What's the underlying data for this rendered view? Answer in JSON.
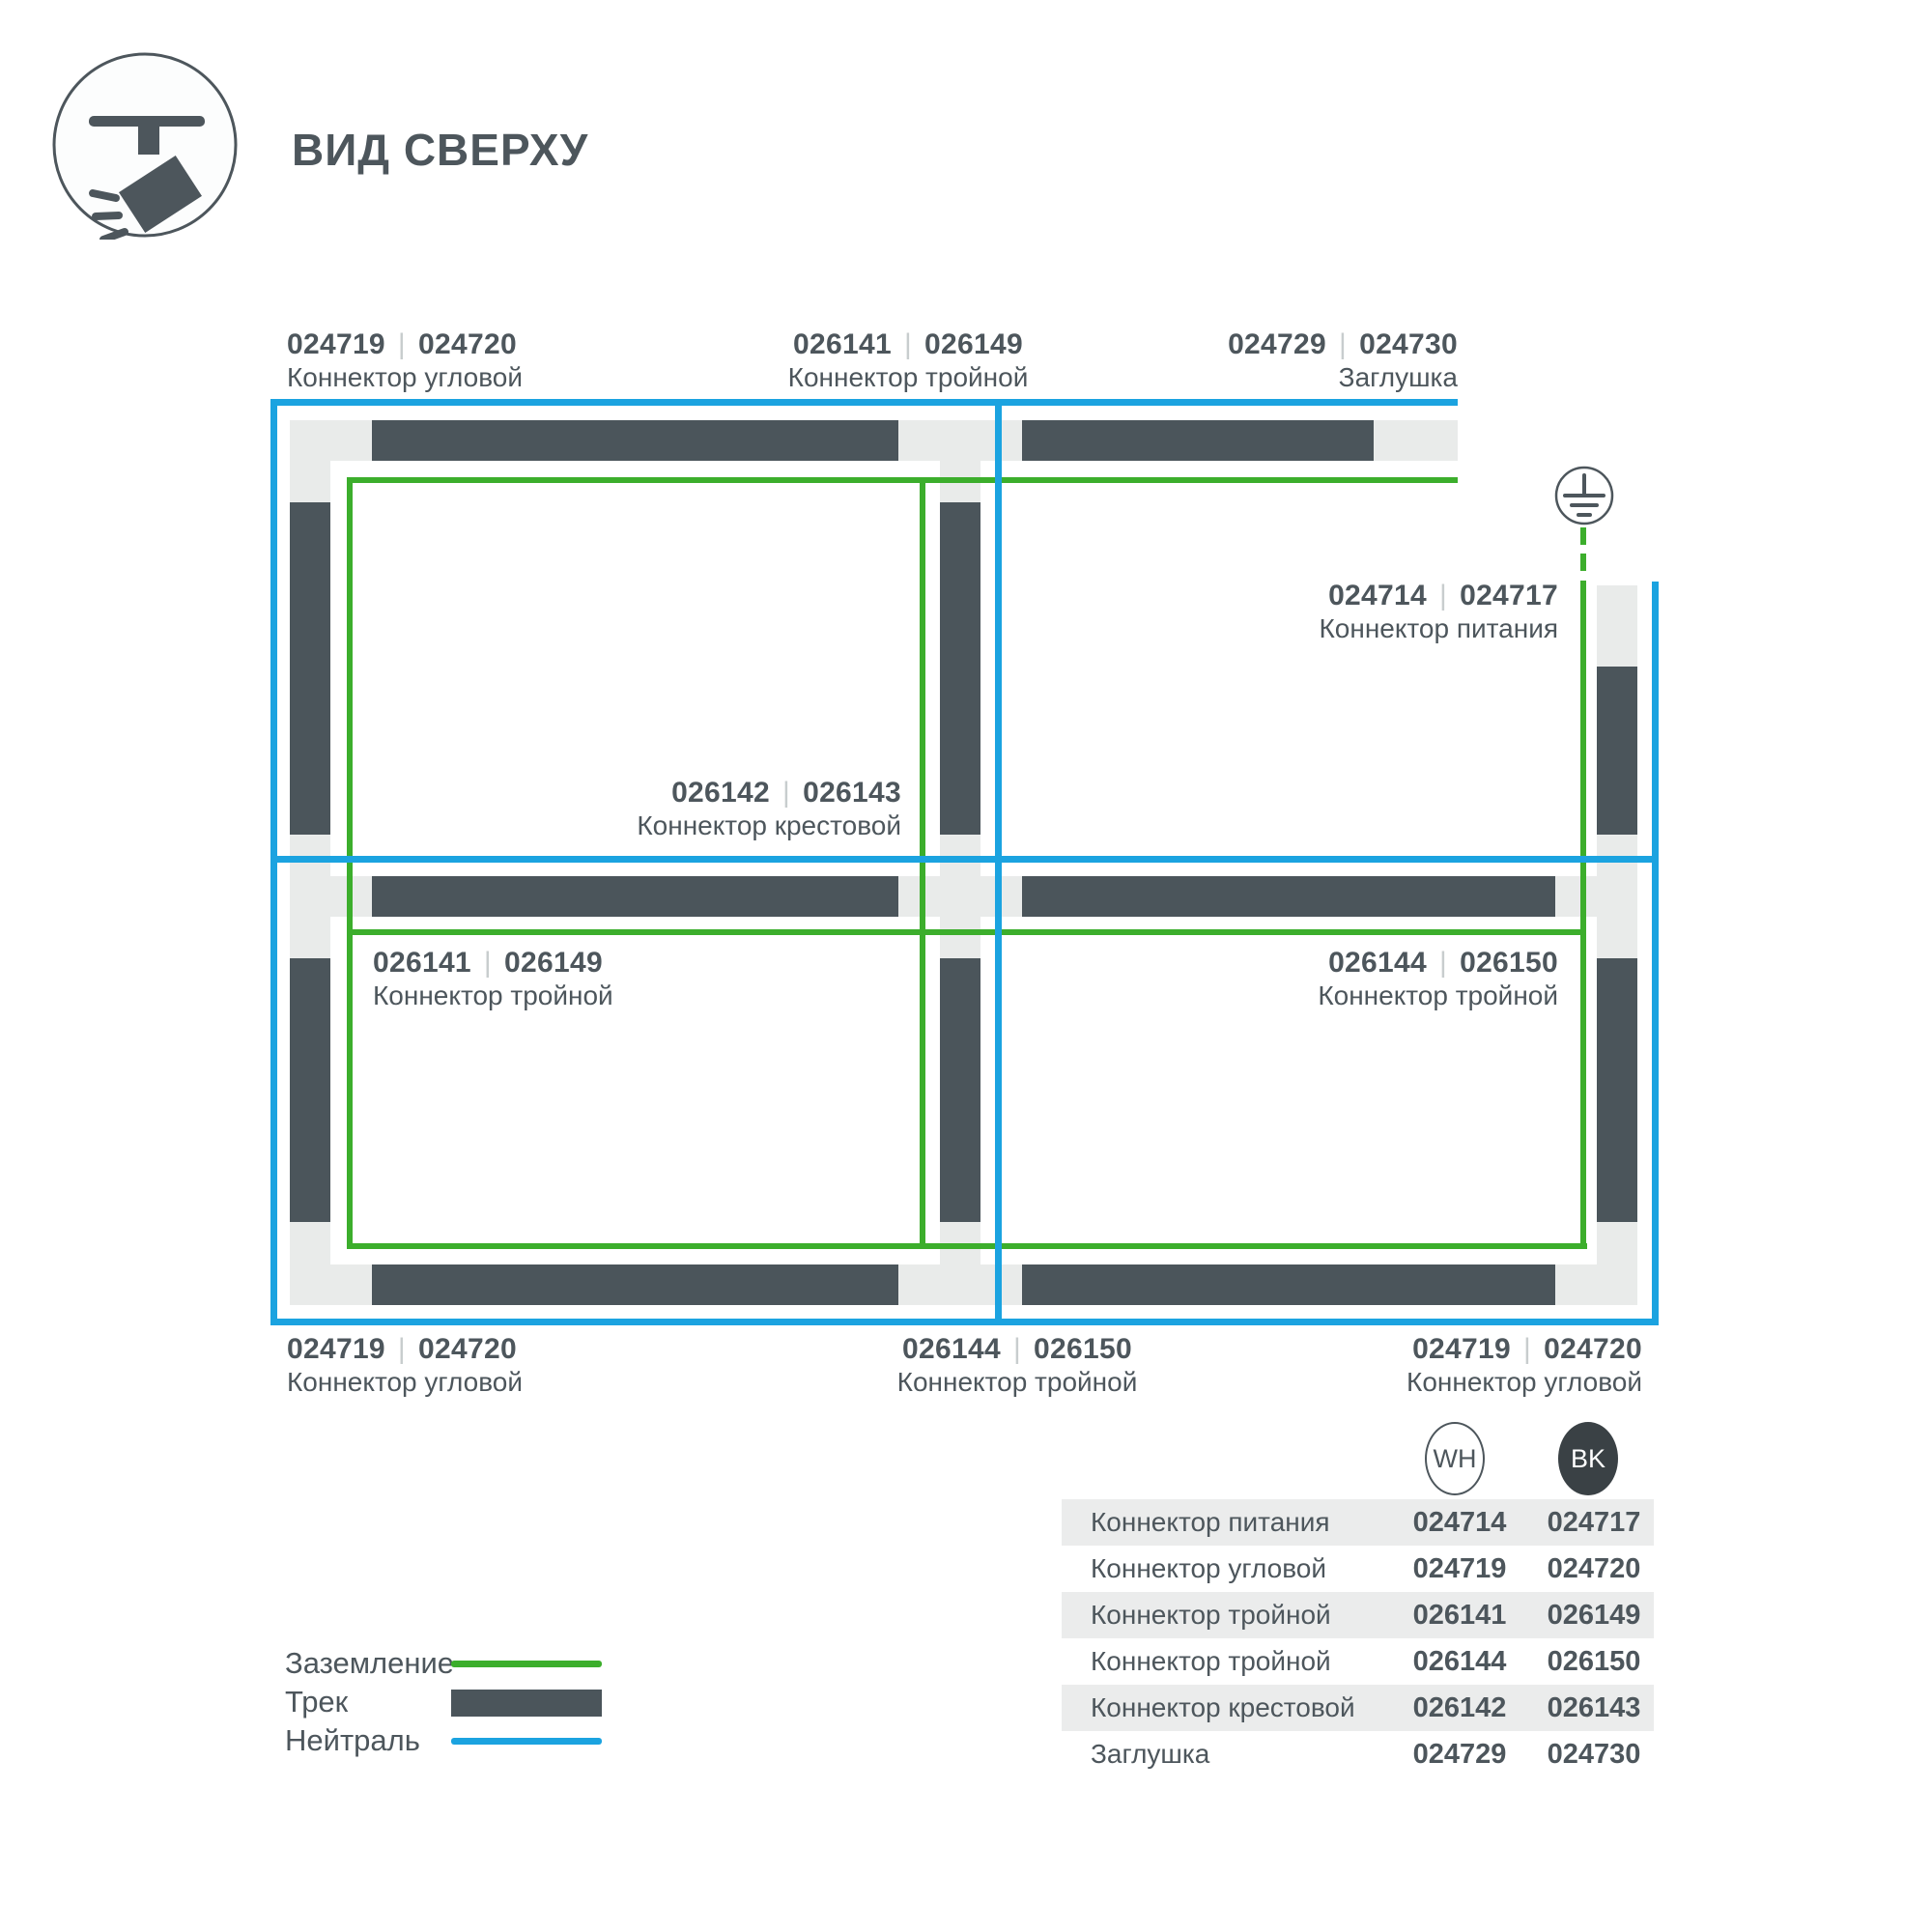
{
  "title": "ВИД СВЕРХУ",
  "separator": "|",
  "colors": {
    "track": "#4b555b",
    "connector_light": "#e9ebea",
    "ground_green": "#3cae2c",
    "neutral_blue": "#1ba3e0",
    "text": "#4d565c",
    "bk_badge": "#3a4145"
  },
  "diagram": {
    "icon": "track-spotlight-top-view",
    "ground_symbol": "earth-ground",
    "labels": [
      {
        "pos": "top-left",
        "wh": "024719",
        "bk": "024720",
        "name": "Коннектор угловой"
      },
      {
        "pos": "top-center",
        "wh": "026141",
        "bk": "026149",
        "name": "Коннектор тройной"
      },
      {
        "pos": "top-right",
        "wh": "024729",
        "bk": "024730",
        "name": "Заглушка"
      },
      {
        "pos": "room-upper-right",
        "wh": "024714",
        "bk": "024717",
        "name": "Коннектор питания"
      },
      {
        "pos": "room-upper-left",
        "wh": "026142",
        "bk": "026143",
        "name": "Коннектор крестовой"
      },
      {
        "pos": "room-lower-left",
        "wh": "026141",
        "bk": "026149",
        "name": "Коннектор тройной"
      },
      {
        "pos": "room-lower-right",
        "wh": "026144",
        "bk": "026150",
        "name": "Коннектор тройной"
      },
      {
        "pos": "bottom-left",
        "wh": "024719",
        "bk": "024720",
        "name": "Коннектор угловой"
      },
      {
        "pos": "bottom-center",
        "wh": "026144",
        "bk": "026150",
        "name": "Коннектор тройной"
      },
      {
        "pos": "bottom-right",
        "wh": "024719",
        "bk": "024720",
        "name": "Коннектор угловой"
      }
    ]
  },
  "legend": [
    {
      "label": "Заземление",
      "swatch": "ground-line"
    },
    {
      "label": "Трек",
      "swatch": "track-bar"
    },
    {
      "label": "Нейтраль",
      "swatch": "neutral-line"
    }
  ],
  "table": {
    "columns": [
      {
        "code": "WH"
      },
      {
        "code": "BK"
      }
    ],
    "rows": [
      {
        "label": "Коннектор питания",
        "wh": "024714",
        "bk": "024717"
      },
      {
        "label": "Коннектор угловой",
        "wh": "024719",
        "bk": "024720"
      },
      {
        "label": "Коннектор тройной",
        "wh": "026141",
        "bk": "026149"
      },
      {
        "label": "Коннектор тройной",
        "wh": "026144",
        "bk": "026150"
      },
      {
        "label": "Коннектор крестовой",
        "wh": "026142",
        "bk": "026143"
      },
      {
        "label": "Заглушка",
        "wh": "024729",
        "bk": "024730"
      }
    ]
  }
}
